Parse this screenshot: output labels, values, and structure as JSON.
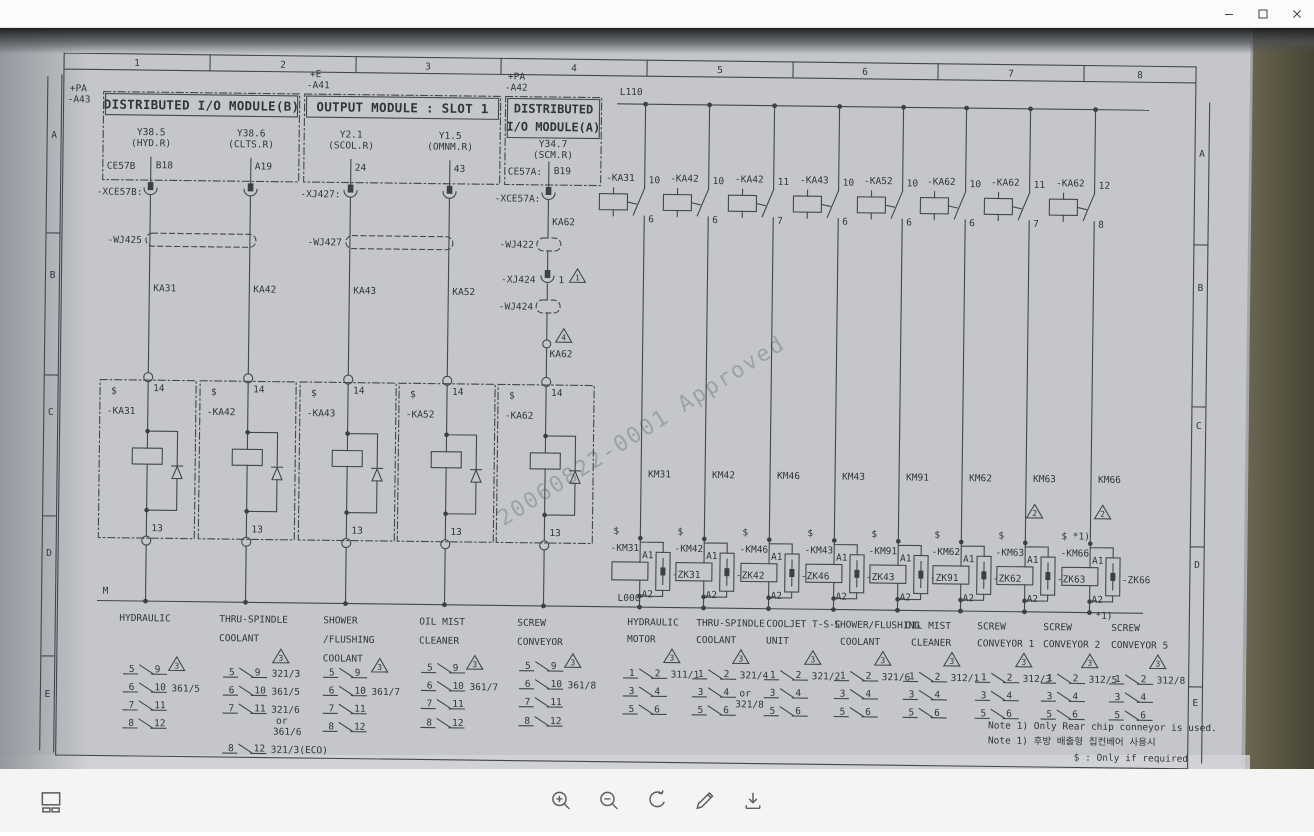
{
  "window": {
    "controls": [
      "minimize",
      "maximize",
      "close"
    ]
  },
  "toolbar": {
    "buttons": [
      "thumbnails",
      "zoom-in",
      "zoom-out",
      "rotate",
      "edit",
      "download"
    ]
  },
  "schematic": {
    "watermark": "20060822-0001 Approved",
    "cols": [
      "1",
      "2",
      "3",
      "4",
      "5",
      "6",
      "7",
      "8"
    ],
    "rows": [
      "A",
      "B",
      "C",
      "D",
      "E"
    ],
    "tags": {
      "a43_1": "+PA",
      "a43_2": "-A43",
      "a41_1": "+E",
      "a41_2": "-A41",
      "a42_1": "+PA",
      "a42_2": "-A42"
    },
    "buses": {
      "l110": "L110",
      "m": "M",
      "l000": "L000"
    },
    "headers": {
      "b": "DISTRIBUTED I/O MODULE(B)",
      "slot1": "OUTPUT MODULE : SLOT 1",
      "a_1": "DISTRIBUTED",
      "a_2": "I/O MODULE(A)"
    },
    "io": [
      {
        "sig": "Y38.5",
        "fn": "(HYD.R)",
        "tb": "CE57B",
        "pin": "B18",
        "conn": "-XCE57B:",
        "wire": "KA31",
        "relay": "-KA31",
        "s": "$",
        "p14": "14",
        "p13": "13"
      },
      {
        "sig": "Y38.6",
        "fn": "(CLTS.R)",
        "pin": "A19",
        "wire": "KA42",
        "relay": "-KA42",
        "s": "$",
        "p14": "14",
        "p13": "13"
      },
      {
        "sig": "Y2.1",
        "fn": "(SCOL.R)",
        "pin": "24",
        "conn": "-XJ427:",
        "wire": "KA43",
        "relay": "-KA43",
        "s": "$",
        "p14": "14",
        "p13": "13"
      },
      {
        "sig": "Y1.5",
        "fn": "(OMNM.R)",
        "pin": "43",
        "wire": "KA52",
        "relay": "-KA52",
        "s": "$",
        "p14": "14",
        "p13": "13"
      },
      {
        "sig": "Y34.7",
        "fn": "(SCM.R)",
        "tb": "CE57A:",
        "pin": "B19",
        "conn": "-XCE57A:",
        "relay": "-KA62",
        "s": "$",
        "p14": "14",
        "p13": "13"
      }
    ],
    "cables": {
      "wj425": "-WJ425",
      "wj427": "-WJ427",
      "wj422": "-WJ422",
      "wj424": "-WJ424",
      "xj424": "-XJ424",
      "xj424_pin": "1",
      "tri_warn": "1",
      "tri4": "4",
      "ka62": "KA62"
    },
    "ka": [
      {
        "name": "-KA31",
        "t": "10",
        "b": "6"
      },
      {
        "name": "-KA42",
        "t": "10",
        "b": "6"
      },
      {
        "name": "-KA42",
        "t": "11",
        "b": "7"
      },
      {
        "name": "-KA43",
        "t": "10",
        "b": "6"
      },
      {
        "name": "-KA52",
        "t": "10",
        "b": "6"
      },
      {
        "name": "-KA62",
        "t": "10",
        "b": "6"
      },
      {
        "name": "-KA62",
        "t": "11",
        "b": "7"
      },
      {
        "name": "-KA62",
        "t": "12",
        "b": "8"
      }
    ],
    "km": [
      {
        "wire": "KM31",
        "s": "$",
        "coil": "-KM31",
        "zk": "-ZK31",
        "a1": "A1",
        "a2": "A2"
      },
      {
        "wire": "KM42",
        "s": "$",
        "coil": "-KM42",
        "zk": "-ZK42",
        "a1": "A1",
        "a2": "A2"
      },
      {
        "wire": "KM46",
        "s": "$",
        "coil": "-KM46",
        "zk": "-ZK46",
        "a1": "A1",
        "a2": "A2"
      },
      {
        "wire": "KM43",
        "s": "$",
        "coil": "-KM43",
        "zk": "-ZK43",
        "a1": "A1",
        "a2": "A2"
      },
      {
        "wire": "KM91",
        "s": "$",
        "coil": "-KM91",
        "zk": "-ZK91",
        "a1": "A1",
        "a2": "A2"
      },
      {
        "wire": "KM62",
        "s": "$",
        "coil": "-KM62",
        "zk": "-ZK62",
        "a1": "A1",
        "a2": "A2"
      },
      {
        "wire": "KM63",
        "s": "$",
        "coil": "-KM63",
        "zk": "-ZK63",
        "a1": "A1",
        "a2": "A2",
        "tri": "2"
      },
      {
        "wire": "KM66",
        "s": "$ *1)",
        "coil": "-KM66",
        "zk": "-ZK66",
        "a1": "A1",
        "a2": "A2",
        "tri": "2"
      }
    ],
    "loads_left": [
      {
        "l1": "HYDRAULIC",
        "tri": "3",
        "rows": [
          [
            "5",
            "9"
          ],
          [
            "6",
            "10",
            "361/5"
          ],
          [
            "7",
            "11"
          ],
          [
            "8",
            "12"
          ]
        ]
      },
      {
        "l1": "THRU-SPINDLE",
        "l2": "COOLANT",
        "tri": "3",
        "or1": "or",
        "or2": "361/6",
        "rows": [
          [
            "5",
            "9",
            "321/3"
          ],
          [
            "6",
            "10",
            "361/5"
          ],
          [
            "7",
            "11",
            "321/6"
          ],
          [
            "8",
            "12",
            "321/3(ECO)"
          ]
        ]
      },
      {
        "l1": "SHOWER",
        "l2": "/FLUSHING",
        "l3": "COOLANT",
        "tri": "3",
        "rows": [
          [
            "5",
            "9"
          ],
          [
            "6",
            "10",
            "361/7"
          ],
          [
            "7",
            "11"
          ],
          [
            "8",
            "12"
          ]
        ]
      },
      {
        "l1": "OIL MIST",
        "l2": "CLEANER",
        "tri": "3",
        "rows": [
          [
            "5",
            "9"
          ],
          [
            "6",
            "10",
            "361/7"
          ],
          [
            "7",
            "11"
          ],
          [
            "8",
            "12"
          ]
        ]
      },
      {
        "l1": "SCREW",
        "l2": "CONVEYOR",
        "tri": "3",
        "rows": [
          [
            "5",
            "9"
          ],
          [
            "6",
            "10",
            "361/8"
          ],
          [
            "7",
            "11"
          ],
          [
            "8",
            "12"
          ]
        ]
      }
    ],
    "loads_right": [
      {
        "l1": "HYDRAULIC",
        "l2": "MOTOR",
        "tri": "3",
        "rows": [
          [
            "1",
            "2",
            "311/1"
          ],
          [
            "3",
            "4"
          ],
          [
            "5",
            "6"
          ]
        ]
      },
      {
        "l1": "THRU-SPINDLE",
        "l2": "COOLANT",
        "tri": "3",
        "or1": "or",
        "or2": "321/8",
        "rows": [
          [
            "1",
            "2",
            "321/4"
          ],
          [
            "3",
            "4"
          ],
          [
            "5",
            "6"
          ]
        ]
      },
      {
        "l1": "COOLJET T-S-C",
        "l2": "UNIT",
        "tri": "3",
        "rows": [
          [
            "1",
            "2",
            "321/2"
          ],
          [
            "3",
            "4"
          ],
          [
            "5",
            "6"
          ]
        ]
      },
      {
        "l1": "SHOWER/FLUSHING",
        "l2": "COOLANT",
        "tri": "3",
        "rows": [
          [
            "1",
            "2",
            "321/6"
          ],
          [
            "3",
            "4"
          ],
          [
            "5",
            "6"
          ]
        ]
      },
      {
        "l1": "OIL MIST",
        "l2": "CLEANER",
        "tri": "3",
        "rows": [
          [
            "1",
            "2",
            "312/1"
          ],
          [
            "3",
            "4"
          ],
          [
            "5",
            "6"
          ]
        ]
      },
      {
        "l1": "SCREW",
        "l2": "CONVEYOR 1",
        "tri": "3",
        "rows": [
          [
            "1",
            "2",
            "312/3"
          ],
          [
            "3",
            "4"
          ],
          [
            "5",
            "6"
          ]
        ]
      },
      {
        "l1": "SCREW",
        "l2": "CONVEYOR 2",
        "tri": "3",
        "rows": [
          [
            "1",
            "2",
            "312/5"
          ],
          [
            "3",
            "4"
          ],
          [
            "5",
            "6"
          ]
        ]
      },
      {
        "l1": "SCREW",
        "l2": "CONVEYOR 5",
        "note": "*1)",
        "tri": "3",
        "rows": [
          [
            "1",
            "2",
            "312/8"
          ],
          [
            "3",
            "4"
          ],
          [
            "5",
            "6"
          ]
        ]
      }
    ],
    "notes": {
      "n1": "Note 1)  Only Rear chip conneyor is used.",
      "n2": "Note 1)  후방 배출형 칩컨베어 사용시",
      "n3": "$ : Only if required"
    }
  }
}
